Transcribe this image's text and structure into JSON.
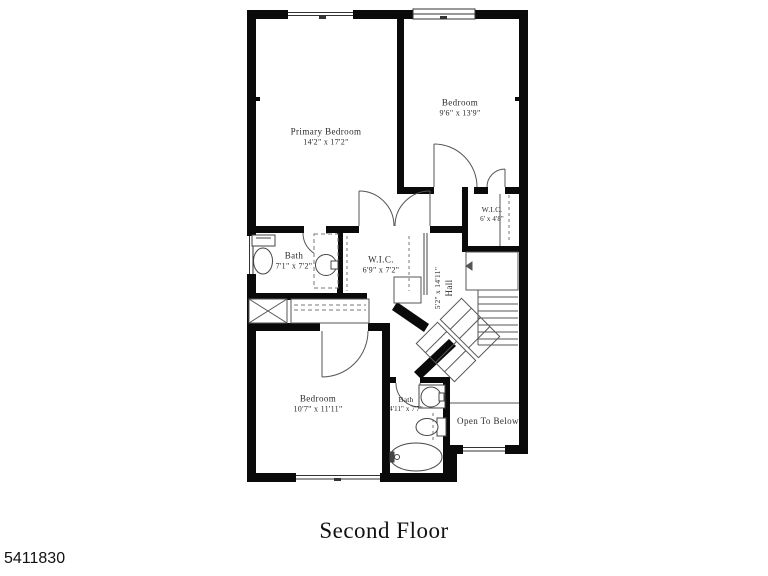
{
  "title": "Second Floor",
  "listing_number": "5411830",
  "rooms": {
    "primary_bedroom": {
      "name": "Primary Bedroom",
      "dims": "14'2\" x 17'2\""
    },
    "bedroom_top": {
      "name": "Bedroom",
      "dims": "9'6\" x 13'9\""
    },
    "wic_right": {
      "name": "W.I.C.",
      "dims": "6' x 4'8\""
    },
    "bath_top": {
      "name": "Bath",
      "dims": "7'1\" x 7'2\""
    },
    "wic_mid": {
      "name": "W.I.C.",
      "dims": "6'9\" x 7'2\""
    },
    "hall": {
      "name": "Hall",
      "dims": "5'2\" x 14'11\""
    },
    "bedroom_bottom": {
      "name": "Bedroom",
      "dims": "10'7\" x 11'11\""
    },
    "bath_bottom": {
      "name": "Bath",
      "dims": "4'11\" x 7'7\""
    },
    "open_to_below": {
      "name": "Open To Below"
    }
  },
  "colors": {
    "wall": "#0a0a0a",
    "line": "#444444",
    "background": "#ffffff"
  }
}
